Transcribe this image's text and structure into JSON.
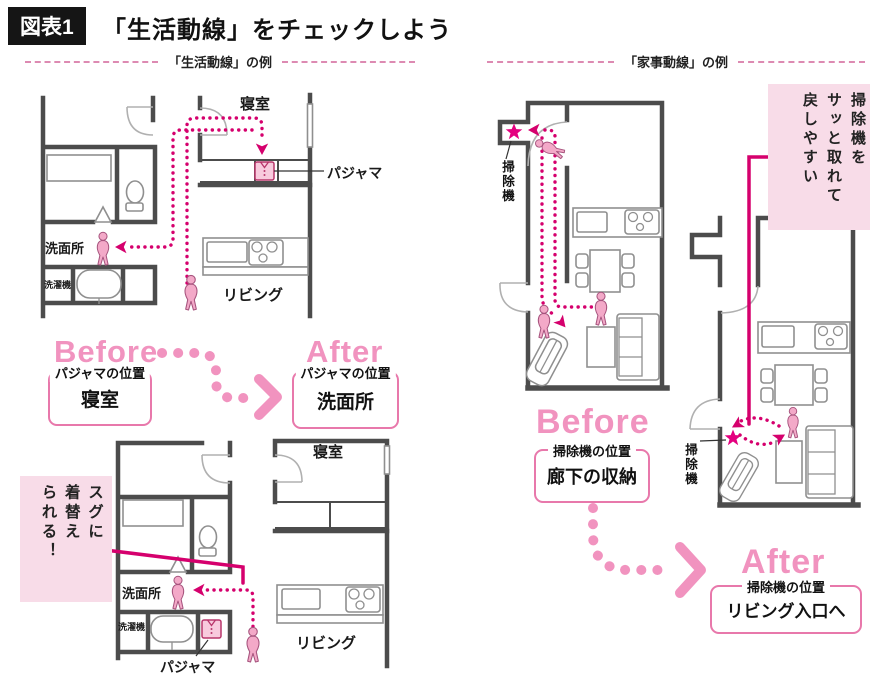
{
  "header": {
    "figure_tag": "図表1",
    "title": "「生活動線」をチェックしよう"
  },
  "sections": {
    "life": {
      "heading": "「生活動線」の例"
    },
    "housework": {
      "heading": "「家事動線」の例"
    }
  },
  "plan_labels": {
    "life_before": {
      "bedroom": "寝室",
      "pajama": "パジャマ",
      "washroom": "洗面所",
      "washer": "洗濯機",
      "living": "リビング"
    },
    "life_after": {
      "bedroom": "寝室",
      "pajama": "パジャマ",
      "washroom": "洗面所",
      "washer": "洗濯機",
      "living": "リビング"
    },
    "housework_before": {
      "vacuum": "掃除機"
    },
    "housework_after": {
      "vacuum": "掃除機"
    }
  },
  "life_compare": {
    "before_label": "Before",
    "after_label": "After",
    "before_box": {
      "caption": "パジャマの位置",
      "value": "寝室"
    },
    "after_box": {
      "caption": "パジャマの位置",
      "value": "洗面所"
    }
  },
  "housework_compare": {
    "before_label": "Before",
    "after_label": "After",
    "before_box": {
      "caption": "掃除機の位置",
      "value": "廊下の収納"
    },
    "after_box": {
      "caption": "掃除機の位置",
      "value": "リビング入口へ"
    }
  },
  "annotations": {
    "change_quickly": "スグに\n着替え\nられる！",
    "vacuum_easy": "掃除機を\nサッと取れて\n戻しやすい"
  },
  "icons": {
    "person": "person-figure",
    "star": "vacuum-spot-star",
    "pajama": "pajama-shirt-icon",
    "vacuum": "vacuum-cleaner-icon"
  },
  "colors": {
    "flow_magenta": "#d5006d",
    "accent_pink": "#f193bf",
    "box_border_pink": "#e878ab",
    "annotation_bg": "#f8dce8",
    "wall": "#4c4c4c",
    "fixture_gray": "#8f8f8f",
    "person_fill": "#f3a9c8",
    "star": "#e4007f"
  }
}
